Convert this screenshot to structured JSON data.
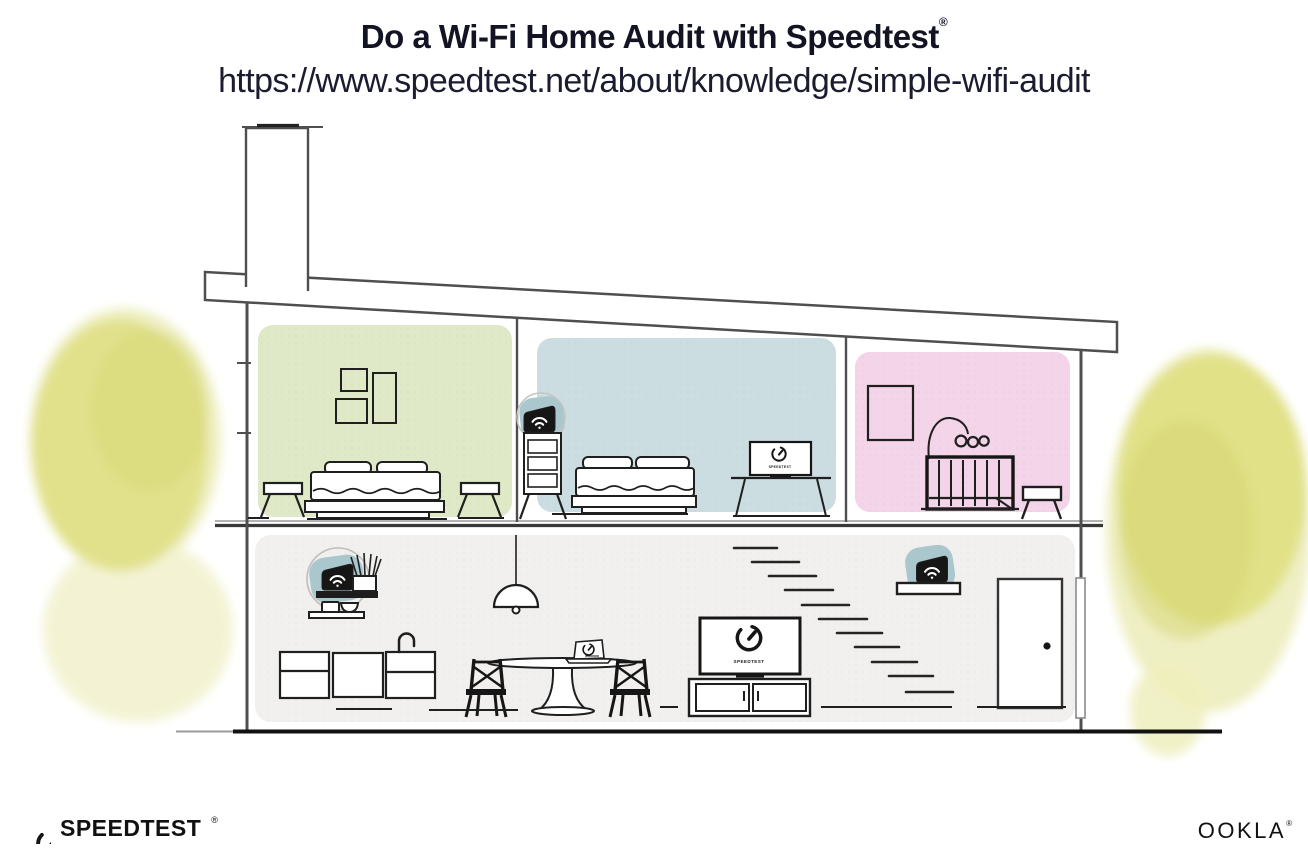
{
  "header": {
    "title": "Do a Wi-Fi Home Audit with Speedtest",
    "registered_mark": "®",
    "url": "https://www.speedtest.net/about/knowledge/simple-wifi-audit"
  },
  "illustration": {
    "colors": {
      "room_green": "#dfe9c7",
      "room_blue": "#cbdde1",
      "room_pink": "#f3d4e8",
      "ground_floor": "#f1f0ee",
      "mesh_highlight_teal": "#a9c7cd",
      "tree_yellow": "#dfdf85",
      "tree_yellow_wash": "#efefc4",
      "outline_dark": "#1f1f1f",
      "architecture_gray": "#4f4f4f"
    },
    "screens": {
      "bedroom_tv_label": "SPEEDTEST",
      "living_tv_label": "SPEEDTEST"
    }
  },
  "footer": {
    "speedtest_wordmark": "SPEEDTEST",
    "speedtest_registered": "®",
    "ookla_wordmark": "OOKLA",
    "ookla_registered": "®"
  }
}
